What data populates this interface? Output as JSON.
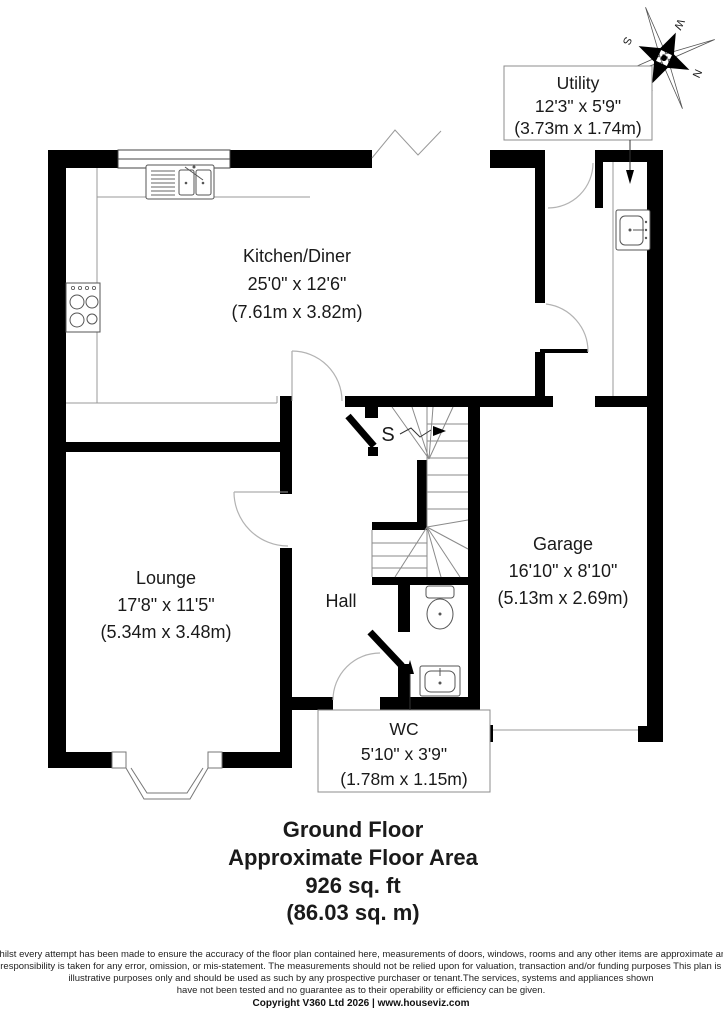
{
  "title_block": {
    "floor": "Ground Floor",
    "area_label": "Approximate Floor Area",
    "area_imperial": "926 sq. ft",
    "area_metric": "(86.03 sq. m)"
  },
  "rooms": {
    "kitchen_diner": {
      "name": "Kitchen/Diner",
      "imperial": "25'0\" x 12'6\"",
      "metric": "(7.61m x 3.82m)"
    },
    "lounge": {
      "name": "Lounge",
      "imperial": "17'8\" x 11'5\"",
      "metric": "(5.34m x 3.48m)"
    },
    "garage": {
      "name": "Garage",
      "imperial": "16'10\" x 8'10\"",
      "metric": "(5.13m x 2.69m)"
    },
    "utility": {
      "name": "Utility",
      "imperial": "12'3\" x 5'9\"",
      "metric": "(3.73m x 1.74m)"
    },
    "wc": {
      "name": "WC",
      "imperial": "5'10\" x 3'9\"",
      "metric": "(1.78m x 1.15m)"
    },
    "hall": {
      "name": "Hall"
    },
    "stairs": {
      "label": "S"
    }
  },
  "compass": {
    "north": "N",
    "east": "E",
    "south": "S",
    "west": "W"
  },
  "disclaimer": {
    "lines": [
      "Whilst every attempt has been made to ensure the accuracy of the floor plan contained here, measurements of doors, windows, rooms and any other items are approximate and",
      "no responsibility is taken for any error, omission, or mis-statement.  The measurements should not be relied upon for valuation, transaction and/or funding purposes This plan is for",
      "illustrative purposes only and should be used as such by any prospective purchaser or tenant.The services, systems and appliances shown",
      "have not been tested and no guarantee as to their operability or efficiency can be given."
    ],
    "copyright": "Copyright V360 Ltd 2026 | www.houseviz.com"
  },
  "colors": {
    "wall": "#000000",
    "thin_line": "#999999",
    "door_arc": "#b3b3b3",
    "label_border": "#8c8c8c",
    "text": "#1a1a1a"
  }
}
